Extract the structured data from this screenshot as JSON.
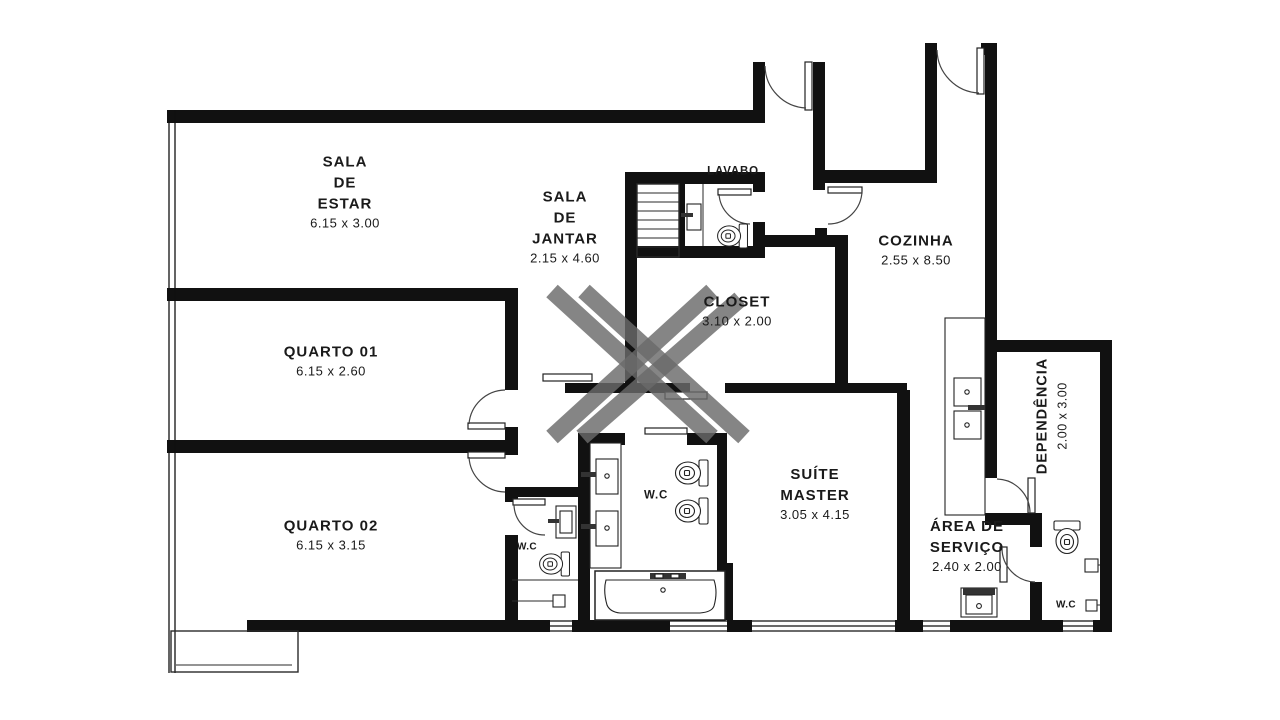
{
  "plan": {
    "type": "apartment-floor-plan",
    "colors": {
      "wall": "#111111",
      "background": "#ffffff",
      "watermark": "#6a6a6a",
      "text": "#1a1a1a"
    },
    "watermark_icon": "x-logo-watermark",
    "fixture_icons": [
      "staircase",
      "toilet",
      "sink",
      "vanity-double-sink",
      "bathtub",
      "kitchen-counter-double-basin",
      "laundry-tank",
      "shower-drain",
      "door-swing",
      "sliding-door",
      "window"
    ]
  },
  "rooms": [
    {
      "id": "sala_estar",
      "name_lines": [
        "SALA",
        "DE",
        "ESTAR"
      ],
      "dimensions": "6.15 x 3.00"
    },
    {
      "id": "sala_jantar",
      "name_lines": [
        "SALA",
        "DE",
        "JANTAR"
      ],
      "dimensions": "2.15 x 4.60"
    },
    {
      "id": "quarto01",
      "name_lines": [
        "QUARTO 01"
      ],
      "dimensions": "6.15 x 2.60"
    },
    {
      "id": "quarto02",
      "name_lines": [
        "QUARTO 02"
      ],
      "dimensions": "6.15 x 3.15"
    },
    {
      "id": "cozinha",
      "name_lines": [
        "COZINHA"
      ],
      "dimensions": "2.55 x 8.50"
    },
    {
      "id": "lavabo",
      "name_lines": [
        "LAVABO"
      ],
      "dimensions": ""
    },
    {
      "id": "closet",
      "name_lines": [
        "CLOSET"
      ],
      "dimensions": "3.10 x 2.00"
    },
    {
      "id": "suite_master",
      "name_lines": [
        "SUÍTE",
        "MASTER"
      ],
      "dimensions": "3.05 x 4.15"
    },
    {
      "id": "dependencia",
      "name_lines": [
        "DEPENDÊNCIA"
      ],
      "dimensions": "2.00 x 3.00"
    },
    {
      "id": "area_servico",
      "name_lines": [
        "ÁREA DE",
        "SERVIÇO"
      ],
      "dimensions": "2.40 x 2.00"
    },
    {
      "id": "wc_master",
      "name_lines": [
        "W.C"
      ],
      "dimensions": ""
    },
    {
      "id": "wc_hall",
      "name_lines": [
        "W.C"
      ],
      "dimensions": ""
    },
    {
      "id": "wc_servico",
      "name_lines": [
        "W.C"
      ],
      "dimensions": ""
    }
  ]
}
